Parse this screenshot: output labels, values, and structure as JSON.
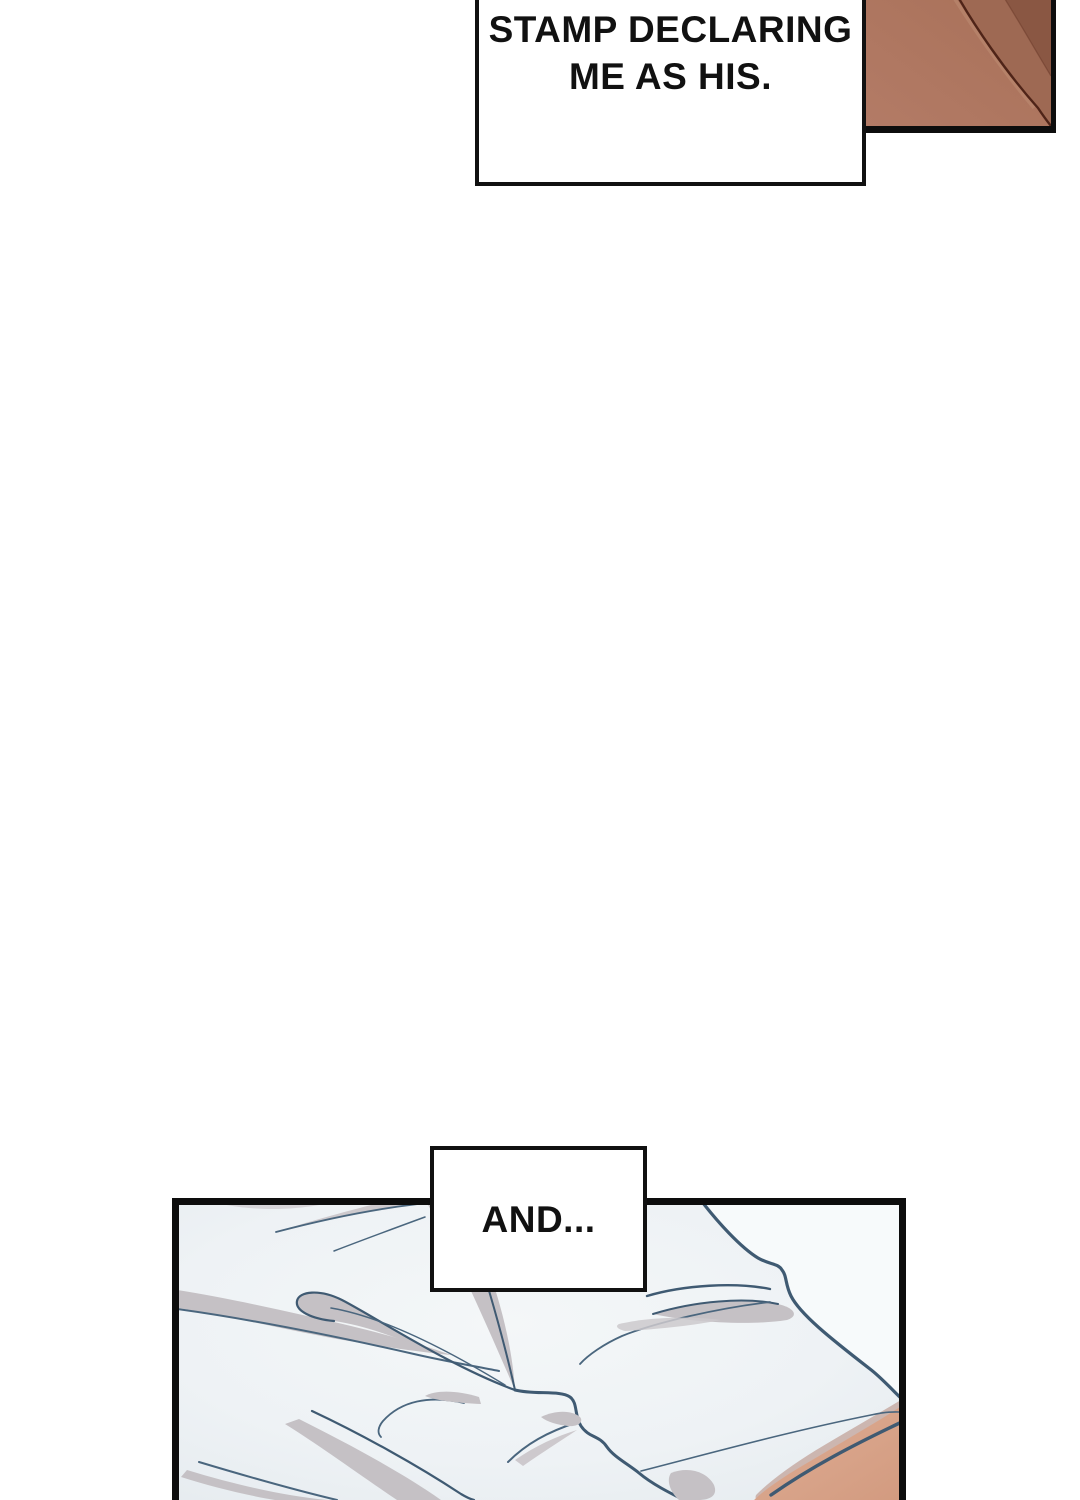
{
  "captions": {
    "top": {
      "lines": [
        "...IS LIKE A",
        "STAMP DECLARING",
        "ME AS HIS."
      ]
    },
    "and": {
      "text": "AND..."
    }
  },
  "colors": {
    "page_bg": "#ffffff",
    "ink": "#111111",
    "panel_border": "#0d0d0d",
    "sheet_bg": "#edf1f4",
    "sheet_bg_center": "#f4f7f8",
    "sheet_bg_edge": "#e4eaee",
    "sheet_white": "#f7fafb",
    "fold_line": "#3f5a72",
    "fold_line_soft": "#4a667e",
    "fold_shadow": "#c5c1c5",
    "fold_shadow_light": "#cdc9cd",
    "skin_light": "#b37b66",
    "skin_mid": "#9e6953",
    "skin_dark": "#8a5743",
    "skin_crease": "#4f2418",
    "skin_highlight": "#c09277",
    "skin_warm": "#dfae95",
    "skin_warm_deep": "#d29a7f",
    "skin_warm_shadow": "#ccb6b0"
  }
}
